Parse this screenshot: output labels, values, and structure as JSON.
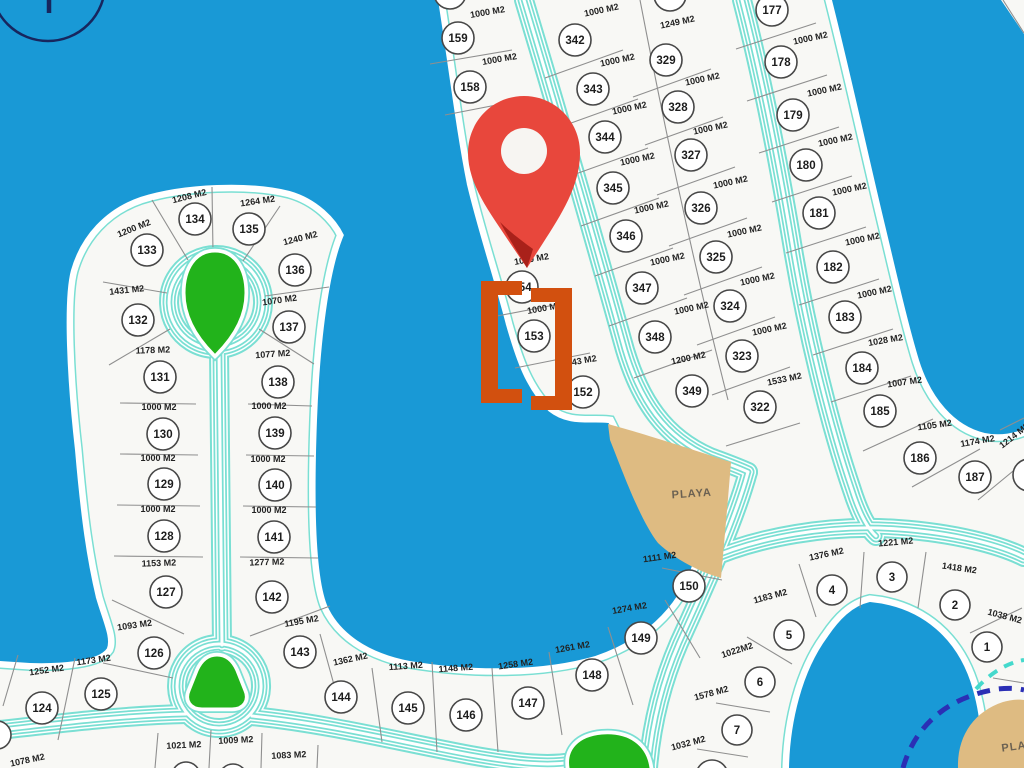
{
  "map": {
    "title": "Lot plat map with location pin",
    "colors": {
      "water": "#1999d6",
      "land": "#f8f8f5",
      "road": "#7adfd3",
      "park": "#22b31b",
      "playa": "#debb82",
      "navy": "#2b2fb5",
      "pin": "#e8473c",
      "bracket": "#d2500f"
    },
    "highlighted_lot": "154",
    "playa_labels": [
      {
        "text": "PLAYA",
        "x": 692,
        "y": 497,
        "rot": -4
      },
      {
        "text": "PLAYA",
        "x": 1022,
        "y": 749,
        "rot": -8
      }
    ],
    "lots": [
      {
        "num": "133",
        "area": "1200 M2",
        "x": 147,
        "y": 250,
        "lx": 135,
        "ly": 231,
        "lr": -22
      },
      {
        "num": "134",
        "area": "1208 M2",
        "x": 195,
        "y": 219,
        "lx": 190,
        "ly": 199,
        "lr": -14
      },
      {
        "num": "135",
        "area": "1264 M2",
        "x": 249,
        "y": 229,
        "lx": 258,
        "ly": 204,
        "lr": -8
      },
      {
        "num": "136",
        "area": "1240 M2",
        "x": 295,
        "y": 270,
        "lx": 301,
        "ly": 241,
        "lr": -14
      },
      {
        "num": "132",
        "area": "1431 M2",
        "x": 138,
        "y": 320,
        "lx": 127,
        "ly": 293,
        "lr": -6
      },
      {
        "num": "137",
        "area": "1070 M2",
        "x": 289,
        "y": 327,
        "lx": 280,
        "ly": 303,
        "lr": -8
      },
      {
        "num": "131",
        "area": "1178 M2",
        "x": 160,
        "y": 377,
        "lx": 153,
        "ly": 353,
        "lr": -2
      },
      {
        "num": "138",
        "area": "1077 M2",
        "x": 278,
        "y": 382,
        "lx": 273,
        "ly": 357,
        "lr": -4
      },
      {
        "num": "130",
        "area": "1000 M2",
        "x": 163,
        "y": 434,
        "lx": 159,
        "ly": 410,
        "lr": 0
      },
      {
        "num": "139",
        "area": "1000 M2",
        "x": 275,
        "y": 433,
        "lx": 269,
        "ly": 409,
        "lr": 0
      },
      {
        "num": "129",
        "area": "1000 M2",
        "x": 164,
        "y": 484,
        "lx": 158,
        "ly": 461,
        "lr": 0
      },
      {
        "num": "140",
        "area": "1000 M2",
        "x": 275,
        "y": 485,
        "lx": 268,
        "ly": 462,
        "lr": 0
      },
      {
        "num": "128",
        "area": "1000 M2",
        "x": 164,
        "y": 536,
        "lx": 158,
        "ly": 512,
        "lr": 0
      },
      {
        "num": "141",
        "area": "1000 M2",
        "x": 274,
        "y": 537,
        "lx": 269,
        "ly": 513,
        "lr": 0
      },
      {
        "num": "127",
        "area": "1153 M2",
        "x": 166,
        "y": 592,
        "lx": 159,
        "ly": 566,
        "lr": -2
      },
      {
        "num": "142",
        "area": "1277 M2",
        "x": 272,
        "y": 597,
        "lx": 267,
        "ly": 565,
        "lr": -2
      },
      {
        "num": "126",
        "area": "1093 M2",
        "x": 154,
        "y": 653,
        "lx": 135,
        "ly": 628,
        "lr": -8
      },
      {
        "num": "143",
        "area": "1195 M2",
        "x": 300,
        "y": 652,
        "lx": 302,
        "ly": 624,
        "lr": -10
      },
      {
        "num": "125",
        "area": "1173 M2",
        "x": 101,
        "y": 694,
        "lx": 94,
        "ly": 663,
        "lr": -8
      },
      {
        "num": "124",
        "area": "1252 M2",
        "x": 42,
        "y": 708,
        "lx": 47,
        "ly": 673,
        "lr": -8
      },
      {
        "num": "144",
        "area": "1362 M2",
        "x": 341,
        "y": 697,
        "lx": 351,
        "ly": 662,
        "lr": -12
      },
      {
        "num": "145",
        "area": "1113 M2",
        "x": 408,
        "y": 708,
        "lx": 406,
        "ly": 669,
        "lr": -4
      },
      {
        "num": "146",
        "area": "1148 M2",
        "x": 466,
        "y": 715,
        "lx": 456,
        "ly": 671,
        "lr": -4
      },
      {
        "num": "147",
        "area": "1258 M2",
        "x": 528,
        "y": 703,
        "lx": 516,
        "ly": 667,
        "lr": -8
      },
      {
        "num": "148",
        "area": "1261 M2",
        "x": 592,
        "y": 675,
        "lx": 573,
        "ly": 650,
        "lr": -10
      },
      {
        "num": "149",
        "area": "1274 M2",
        "x": 641,
        "y": 638,
        "lx": 630,
        "ly": 611,
        "lr": -10
      },
      {
        "num": "150",
        "area": "1111 M2",
        "x": 689,
        "y": 586,
        "lx": 660,
        "ly": 560,
        "lr": -8
      },
      {
        "num": "159",
        "area": "1000 M2",
        "x": 458,
        "y": 38,
        "lx": 488,
        "ly": 15,
        "lr": -10
      },
      {
        "num": "158",
        "area": "1000 M2",
        "x": 470,
        "y": 87,
        "lx": 500,
        "ly": 62,
        "lr": -10
      },
      {
        "num": "154",
        "area": "1000 M2",
        "x": 522,
        "y": 287,
        "lx": 532,
        "ly": 262,
        "lr": -10
      },
      {
        "num": "153",
        "area": "1000 M2",
        "x": 534,
        "y": 336,
        "lx": 545,
        "ly": 311,
        "lr": -10
      },
      {
        "num": "152",
        "area": "1143 M2",
        "x": 583,
        "y": 392,
        "lx": 580,
        "ly": 364,
        "lr": -10
      },
      {
        "num": "342",
        "area": "1000 M2",
        "x": 575,
        "y": 40,
        "lx": 602,
        "ly": 13,
        "lr": -12
      },
      {
        "num": "343",
        "area": "1000 M2",
        "x": 593,
        "y": 89,
        "lx": 618,
        "ly": 63,
        "lr": -12
      },
      {
        "num": "344",
        "area": "1000 M2",
        "x": 605,
        "y": 137,
        "lx": 630,
        "ly": 111,
        "lr": -12
      },
      {
        "num": "345",
        "area": "1000 M2",
        "x": 613,
        "y": 188,
        "lx": 638,
        "ly": 162,
        "lr": -12
      },
      {
        "num": "346",
        "area": "1000 M2",
        "x": 626,
        "y": 236,
        "lx": 652,
        "ly": 210,
        "lr": -12
      },
      {
        "num": "347",
        "area": "1000 M2",
        "x": 642,
        "y": 288,
        "lx": 668,
        "ly": 262,
        "lr": -12
      },
      {
        "num": "348",
        "area": "1000 M2",
        "x": 655,
        "y": 337,
        "lx": 692,
        "ly": 311,
        "lr": -12
      },
      {
        "num": "349",
        "area": "1200 M2",
        "x": 692,
        "y": 391,
        "lx": 689,
        "ly": 361,
        "lr": -12
      },
      {
        "num": "329",
        "area": "1249 M2",
        "x": 666,
        "y": 60,
        "lx": 678,
        "ly": 25,
        "lr": -12
      },
      {
        "num": "328",
        "area": "1000 M2",
        "x": 678,
        "y": 107,
        "lx": 703,
        "ly": 82,
        "lr": -12
      },
      {
        "num": "327",
        "area": "1000 M2",
        "x": 691,
        "y": 155,
        "lx": 711,
        "ly": 131,
        "lr": -12
      },
      {
        "num": "326",
        "area": "1000 M2",
        "x": 701,
        "y": 208,
        "lx": 731,
        "ly": 185,
        "lr": -12
      },
      {
        "num": "325",
        "area": "1000 M2",
        "x": 716,
        "y": 257,
        "lx": 745,
        "ly": 234,
        "lr": -12
      },
      {
        "num": "324",
        "area": "1000 M2",
        "x": 730,
        "y": 306,
        "lx": 758,
        "ly": 282,
        "lr": -12
      },
      {
        "num": "323",
        "area": "1000 M2",
        "x": 742,
        "y": 356,
        "lx": 770,
        "ly": 332,
        "lr": -12
      },
      {
        "num": "322",
        "area": "1533 M2",
        "x": 760,
        "y": 407,
        "lx": 785,
        "ly": 382,
        "lr": -12
      },
      {
        "num": "177",
        "area": null,
        "x": 772,
        "y": 10,
        "lx": 0,
        "ly": 0,
        "lr": 0
      },
      {
        "num": "178",
        "area": "1000 M2",
        "x": 781,
        "y": 62,
        "lx": 811,
        "ly": 41,
        "lr": -12
      },
      {
        "num": "179",
        "area": "1000 M2",
        "x": 793,
        "y": 115,
        "lx": 825,
        "ly": 93,
        "lr": -12
      },
      {
        "num": "180",
        "area": "1000 M2",
        "x": 806,
        "y": 165,
        "lx": 836,
        "ly": 143,
        "lr": -12
      },
      {
        "num": "181",
        "area": "1000 M2",
        "x": 819,
        "y": 213,
        "lx": 850,
        "ly": 192,
        "lr": -12
      },
      {
        "num": "182",
        "area": "1000 M2",
        "x": 833,
        "y": 267,
        "lx": 863,
        "ly": 242,
        "lr": -12
      },
      {
        "num": "183",
        "area": "1000 M2",
        "x": 845,
        "y": 317,
        "lx": 875,
        "ly": 295,
        "lr": -12
      },
      {
        "num": "184",
        "area": "1028 M2",
        "x": 862,
        "y": 368,
        "lx": 886,
        "ly": 343,
        "lr": -10
      },
      {
        "num": "185",
        "area": "1007 M2",
        "x": 880,
        "y": 411,
        "lx": 905,
        "ly": 385,
        "lr": -8
      },
      {
        "num": "186",
        "area": "1105 M2",
        "x": 920,
        "y": 458,
        "lx": 935,
        "ly": 428,
        "lr": -8
      },
      {
        "num": "187",
        "area": "1174 M2",
        "x": 975,
        "y": 477,
        "lx": 978,
        "ly": 444,
        "lr": -10
      },
      {
        "num": "4",
        "area": "1376 M2",
        "x": 832,
        "y": 590,
        "lx": 827,
        "ly": 557,
        "lr": -12
      },
      {
        "num": "3",
        "area": "1221 M2",
        "x": 892,
        "y": 577,
        "lx": 896,
        "ly": 545,
        "lr": -5
      },
      {
        "num": "2",
        "area": "1418 M2",
        "x": 955,
        "y": 605,
        "lx": 959,
        "ly": 571,
        "lr": 8
      },
      {
        "num": "1",
        "area": "1038 M2",
        "x": 987,
        "y": 647,
        "lx": 1004,
        "ly": 619,
        "lr": 15
      },
      {
        "num": "5",
        "area": "1183 M2",
        "x": 789,
        "y": 635,
        "lx": 771,
        "ly": 599,
        "lr": -15
      },
      {
        "num": "6",
        "area": "1022M2",
        "x": 760,
        "y": 682,
        "lx": 738,
        "ly": 653,
        "lr": -18
      },
      {
        "num": "7",
        "area": "1578 M2",
        "x": 737,
        "y": 730,
        "lx": 712,
        "ly": 696,
        "lr": -15
      }
    ],
    "edge_labels": [
      {
        "text": "1078 M2",
        "x": 28,
        "y": 763,
        "rot": -12
      },
      {
        "text": "1021 M2",
        "x": 184,
        "y": 748,
        "rot": -3
      },
      {
        "text": "1009 M2",
        "x": 236,
        "y": 743,
        "rot": -3
      },
      {
        "text": "1083 M2",
        "x": 289,
        "y": 758,
        "rot": -3
      },
      {
        "text": "1032 M2",
        "x": 689,
        "y": 746,
        "rot": -15
      },
      {
        "text": "1214 M2",
        "x": 1016,
        "y": 438,
        "rot": -38
      }
    ]
  }
}
